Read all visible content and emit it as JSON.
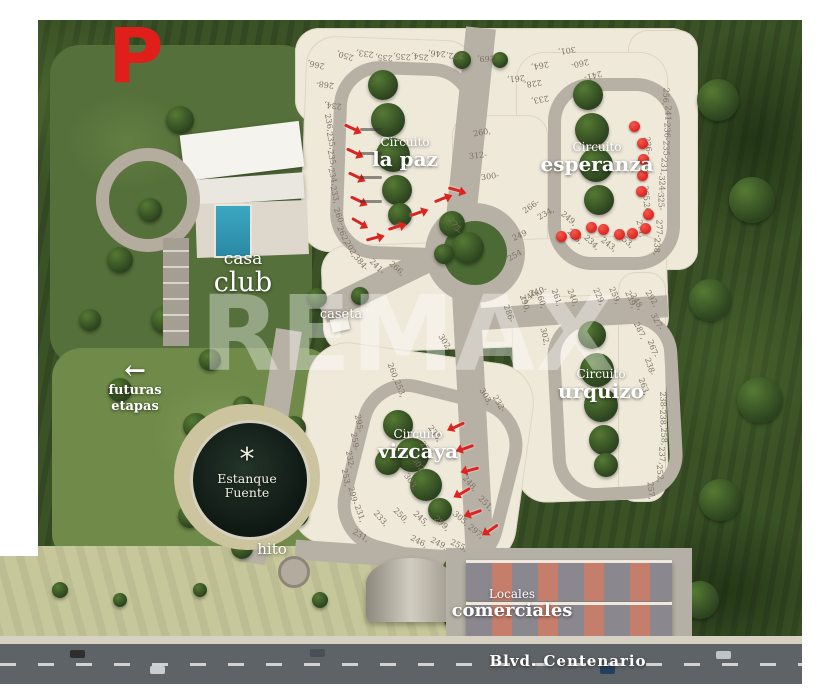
{
  "logo": {
    "letter": "P",
    "color": "#e01f1a"
  },
  "watermark": {
    "text": "REMAX"
  },
  "labels": {
    "circuito_la_paz": {
      "line1": "Circuito",
      "line2": "la paz"
    },
    "circuito_esperanza": {
      "line1": "Circuito",
      "line2": "esperanza"
    },
    "circuito_urquizo": {
      "line1": "Circuito",
      "line2": "urquizo"
    },
    "circuito_vizcaya": {
      "line1": "Circuito",
      "line2": "vizcaya"
    },
    "casa_club": {
      "line1": "casa",
      "line2": "club"
    },
    "caseta": "caseta",
    "futuras_etapas": {
      "arrow": "←",
      "line1": "futuras",
      "line2": "etapas"
    },
    "estanque_fuente": {
      "icon": "*",
      "line1": "Estanque",
      "line2": "Fuente"
    },
    "hito": "hito",
    "locales_comerciales": {
      "line1": "Locales",
      "line2": "comerciales"
    },
    "blvd": "Blvd. Centenario"
  },
  "markers": {
    "sold_color": "#dc2420",
    "arrows": [
      {
        "x": 344,
        "y": 126,
        "r": 25
      },
      {
        "x": 346,
        "y": 150,
        "r": 25
      },
      {
        "x": 348,
        "y": 174,
        "r": 25
      },
      {
        "x": 350,
        "y": 198,
        "r": 25
      },
      {
        "x": 351,
        "y": 220,
        "r": 30
      },
      {
        "x": 366,
        "y": 237,
        "r": -15
      },
      {
        "x": 388,
        "y": 226,
        "r": -18
      },
      {
        "x": 410,
        "y": 212,
        "r": -20
      },
      {
        "x": 434,
        "y": 198,
        "r": -22
      },
      {
        "x": 448,
        "y": 188,
        "r": 15
      },
      {
        "x": 452,
        "y": 424,
        "r": 155
      },
      {
        "x": 461,
        "y": 446,
        "r": 160
      },
      {
        "x": 466,
        "y": 468,
        "r": 165
      },
      {
        "x": 458,
        "y": 490,
        "r": 150
      },
      {
        "x": 469,
        "y": 511,
        "r": 160
      },
      {
        "x": 486,
        "y": 527,
        "r": 145
      }
    ],
    "dots": [
      {
        "x": 629,
        "y": 121
      },
      {
        "x": 637,
        "y": 138
      },
      {
        "x": 638,
        "y": 154
      },
      {
        "x": 637,
        "y": 170
      },
      {
        "x": 636,
        "y": 186
      },
      {
        "x": 643,
        "y": 209
      },
      {
        "x": 640,
        "y": 223
      },
      {
        "x": 627,
        "y": 228
      },
      {
        "x": 614,
        "y": 229
      },
      {
        "x": 598,
        "y": 224
      },
      {
        "x": 586,
        "y": 222
      },
      {
        "x": 570,
        "y": 229
      },
      {
        "x": 556,
        "y": 231
      }
    ]
  },
  "lots": [
    {
      "n": "266,",
      "x": 307,
      "y": 60,
      "r": 192
    },
    {
      "n": "268-",
      "x": 316,
      "y": 80,
      "r": 188
    },
    {
      "n": "234,",
      "x": 324,
      "y": 101,
      "r": 186
    },
    {
      "n": "250,",
      "x": 336,
      "y": 51,
      "r": 196
    },
    {
      "n": "233,",
      "x": 356,
      "y": 49,
      "r": 187
    },
    {
      "n": "235,",
      "x": 375,
      "y": 53,
      "r": 184
    },
    {
      "n": "235,",
      "x": 393,
      "y": 52,
      "r": 184
    },
    {
      "n": "254,",
      "x": 411,
      "y": 52,
      "r": 186
    },
    {
      "n": "246,",
      "x": 428,
      "y": 49,
      "r": 183
    },
    {
      "n": "272,",
      "x": 446,
      "y": 51,
      "r": 181
    },
    {
      "n": "269,",
      "x": 477,
      "y": 54,
      "r": 178
    },
    {
      "n": "301,",
      "x": 558,
      "y": 46,
      "r": 172
    },
    {
      "n": "261,",
      "x": 507,
      "y": 74,
      "r": 174
    },
    {
      "n": "264,",
      "x": 531,
      "y": 61,
      "r": 170
    },
    {
      "n": "228,",
      "x": 524,
      "y": 79,
      "r": 172
    },
    {
      "n": "233,",
      "x": 531,
      "y": 95,
      "r": 170
    },
    {
      "n": "260-",
      "x": 571,
      "y": 59,
      "r": 168
    },
    {
      "n": "241-",
      "x": 584,
      "y": 71,
      "r": 166
    },
    {
      "n": "256,",
      "x": 657,
      "y": 92,
      "r": 92
    },
    {
      "n": "241-",
      "x": 659,
      "y": 110,
      "r": 92
    },
    {
      "n": "236-",
      "x": 658,
      "y": 127,
      "r": 90
    },
    {
      "n": "235-",
      "x": 657,
      "y": 145,
      "r": 90
    },
    {
      "n": "231,",
      "x": 655,
      "y": 162,
      "r": 92
    },
    {
      "n": "324-",
      "x": 653,
      "y": 180,
      "r": 88
    },
    {
      "n": "325-",
      "x": 652,
      "y": 197,
      "r": 88
    },
    {
      "n": "277-",
      "x": 650,
      "y": 224,
      "r": 90
    },
    {
      "n": "238,",
      "x": 648,
      "y": 242,
      "r": 92
    },
    {
      "n": "236-",
      "x": 639,
      "y": 141,
      "r": 82
    },
    {
      "n": "235-",
      "x": 638,
      "y": 161,
      "r": 80
    },
    {
      "n": "265,",
      "x": 637,
      "y": 190,
      "r": 84
    },
    {
      "n": "263,",
      "x": 639,
      "y": 207,
      "r": 80
    },
    {
      "n": "271,",
      "x": 632,
      "y": 224,
      "r": 76
    },
    {
      "n": "253,",
      "x": 617,
      "y": 236,
      "r": 40
    },
    {
      "n": "243,",
      "x": 600,
      "y": 240,
      "r": 38
    },
    {
      "n": "234,",
      "x": 583,
      "y": 238,
      "r": 42
    },
    {
      "n": "236.",
      "x": 566,
      "y": 232,
      "r": 44
    },
    {
      "n": "249,",
      "x": 560,
      "y": 214,
      "r": 40
    },
    {
      "n": "236,",
      "x": 320,
      "y": 118,
      "r": 80
    },
    {
      "n": "235,",
      "x": 322,
      "y": 136,
      "r": 78
    },
    {
      "n": "235,",
      "x": 323,
      "y": 154,
      "r": 78
    },
    {
      "n": "234,",
      "x": 324,
      "y": 172,
      "r": 76
    },
    {
      "n": "233,",
      "x": 326,
      "y": 190,
      "r": 76
    },
    {
      "n": "260-",
      "x": 330,
      "y": 212,
      "r": 70
    },
    {
      "n": "262,",
      "x": 334,
      "y": 230,
      "r": 66
    },
    {
      "n": "202,",
      "x": 342,
      "y": 244,
      "r": 60
    },
    {
      "n": "384-",
      "x": 352,
      "y": 258,
      "r": 50
    },
    {
      "n": "241-",
      "x": 368,
      "y": 262,
      "r": 46
    },
    {
      "n": "266,",
      "x": 388,
      "y": 264,
      "r": 42
    },
    {
      "n": "260,",
      "x": 473,
      "y": 128,
      "r": -10
    },
    {
      "n": "312-",
      "x": 469,
      "y": 151,
      "r": -6
    },
    {
      "n": "300-",
      "x": 481,
      "y": 172,
      "r": -8
    },
    {
      "n": "266-",
      "x": 522,
      "y": 202,
      "r": -35
    },
    {
      "n": "249",
      "x": 512,
      "y": 231,
      "r": -25
    },
    {
      "n": "254",
      "x": 507,
      "y": 251,
      "r": -30
    },
    {
      "n": "275-",
      "x": 446,
      "y": 221,
      "r": 55
    },
    {
      "n": "240-",
      "x": 529,
      "y": 287,
      "r": -20
    },
    {
      "n": "246",
      "x": 522,
      "y": 292,
      "r": -40
    },
    {
      "n": "234,",
      "x": 537,
      "y": 209,
      "r": -30
    },
    {
      "n": "286-",
      "x": 500,
      "y": 309,
      "r": 70
    },
    {
      "n": "290,",
      "x": 516,
      "y": 299,
      "r": 72
    },
    {
      "n": "260,",
      "x": 532,
      "y": 295,
      "r": 70
    },
    {
      "n": "261,",
      "x": 548,
      "y": 293,
      "r": 70
    },
    {
      "n": "240,",
      "x": 564,
      "y": 293,
      "r": 68
    },
    {
      "n": "229,",
      "x": 590,
      "y": 292,
      "r": 66
    },
    {
      "n": "259,",
      "x": 606,
      "y": 291,
      "r": 66
    },
    {
      "n": "239,",
      "x": 622,
      "y": 295,
      "r": 66
    },
    {
      "n": "248,",
      "x": 628,
      "y": 297,
      "r": 60
    },
    {
      "n": "292,",
      "x": 643,
      "y": 294,
      "r": 58
    },
    {
      "n": "287,",
      "x": 631,
      "y": 326,
      "r": 64
    },
    {
      "n": "327-",
      "x": 648,
      "y": 317,
      "r": 62
    },
    {
      "n": "267-",
      "x": 644,
      "y": 344,
      "r": 70
    },
    {
      "n": "238-",
      "x": 641,
      "y": 362,
      "r": 72
    },
    {
      "n": "263,",
      "x": 635,
      "y": 382,
      "r": 70
    },
    {
      "n": "302,",
      "x": 536,
      "y": 332,
      "r": 76
    },
    {
      "n": "238-",
      "x": 654,
      "y": 396,
      "r": 88
    },
    {
      "n": "238,",
      "x": 654,
      "y": 414,
      "r": 88
    },
    {
      "n": "258,",
      "x": 655,
      "y": 432,
      "r": 88
    },
    {
      "n": "237,",
      "x": 653,
      "y": 451,
      "r": 88
    },
    {
      "n": "252,",
      "x": 651,
      "y": 469,
      "r": 86
    },
    {
      "n": "257,",
      "x": 642,
      "y": 486,
      "r": 84
    },
    {
      "n": "302-",
      "x": 436,
      "y": 338,
      "r": 58
    },
    {
      "n": "303,",
      "x": 477,
      "y": 392,
      "r": 60
    },
    {
      "n": "232-",
      "x": 490,
      "y": 399,
      "r": 60
    },
    {
      "n": "260,",
      "x": 384,
      "y": 367,
      "r": 70
    },
    {
      "n": "253,",
      "x": 391,
      "y": 384,
      "r": 68
    },
    {
      "n": "295-",
      "x": 350,
      "y": 419,
      "r": 80
    },
    {
      "n": "259-",
      "x": 346,
      "y": 437,
      "r": 80
    },
    {
      "n": "232-",
      "x": 341,
      "y": 455,
      "r": 80
    },
    {
      "n": "253,",
      "x": 337,
      "y": 473,
      "r": 78
    },
    {
      "n": "299-",
      "x": 344,
      "y": 491,
      "r": 76
    },
    {
      "n": "231,",
      "x": 351,
      "y": 509,
      "r": 70
    },
    {
      "n": "303,",
      "x": 402,
      "y": 477,
      "r": 55
    },
    {
      "n": "302,",
      "x": 410,
      "y": 461,
      "r": 55
    },
    {
      "n": "233,",
      "x": 418,
      "y": 445,
      "r": 55
    },
    {
      "n": "235,",
      "x": 426,
      "y": 429,
      "r": 55
    },
    {
      "n": "305,",
      "x": 452,
      "y": 514,
      "r": 40
    },
    {
      "n": "299,",
      "x": 433,
      "y": 519,
      "r": 42
    },
    {
      "n": "245,",
      "x": 412,
      "y": 514,
      "r": 44
    },
    {
      "n": "250,",
      "x": 392,
      "y": 511,
      "r": 46
    },
    {
      "n": "233,",
      "x": 372,
      "y": 514,
      "r": 48
    },
    {
      "n": "297,",
      "x": 467,
      "y": 527,
      "r": 38
    },
    {
      "n": "251,",
      "x": 477,
      "y": 499,
      "r": 45
    },
    {
      "n": "248,",
      "x": 461,
      "y": 479,
      "r": 48
    },
    {
      "n": "231,",
      "x": 352,
      "y": 531,
      "r": 30
    },
    {
      "n": "246,",
      "x": 410,
      "y": 537,
      "r": 28
    },
    {
      "n": "249,",
      "x": 430,
      "y": 539,
      "r": 28
    },
    {
      "n": "255,",
      "x": 450,
      "y": 541,
      "r": 26
    }
  ]
}
